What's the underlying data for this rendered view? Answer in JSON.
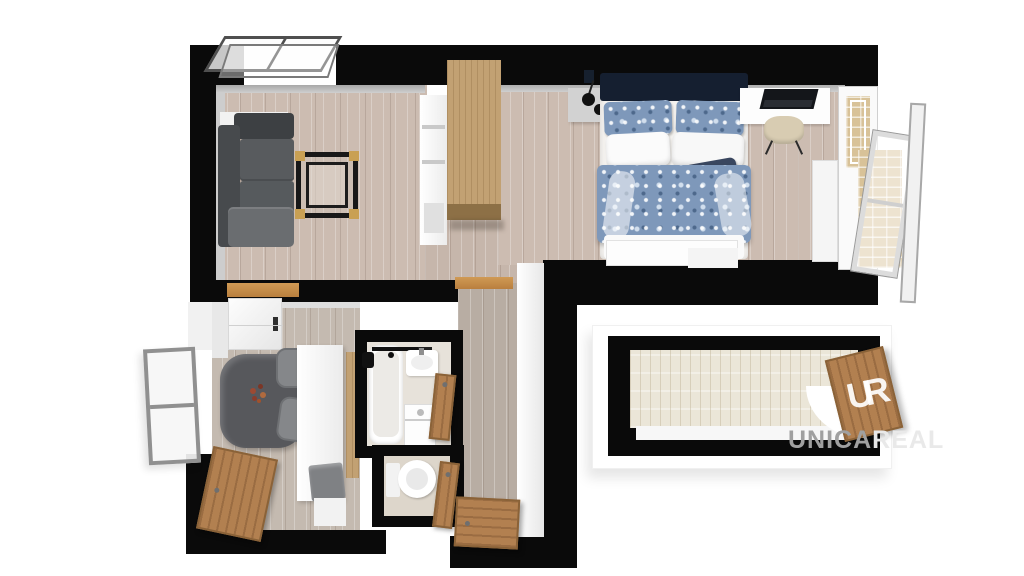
{
  "watermark": {
    "text_primary": "UNICA",
    "text_secondary": "REAL"
  },
  "logo": {
    "monogram": "UR"
  },
  "palette": {
    "wall_black": "#0a0a0a",
    "floor_wood": "#ccbcb1",
    "hall_wood": "#b8ada3",
    "balcony_deck": "#ebe6d8",
    "furniture_wood": "#c2a173",
    "door_wood": "#b28050",
    "sofa_gray": "#56595c",
    "bed_blue": "#7e98ba",
    "headboard_navy": "#151f30",
    "accent_gold": "#c9a053",
    "brick": "#d8c298",
    "watermark_gray": "#a0a0a0",
    "watermark_light": "#e9e9e9"
  }
}
